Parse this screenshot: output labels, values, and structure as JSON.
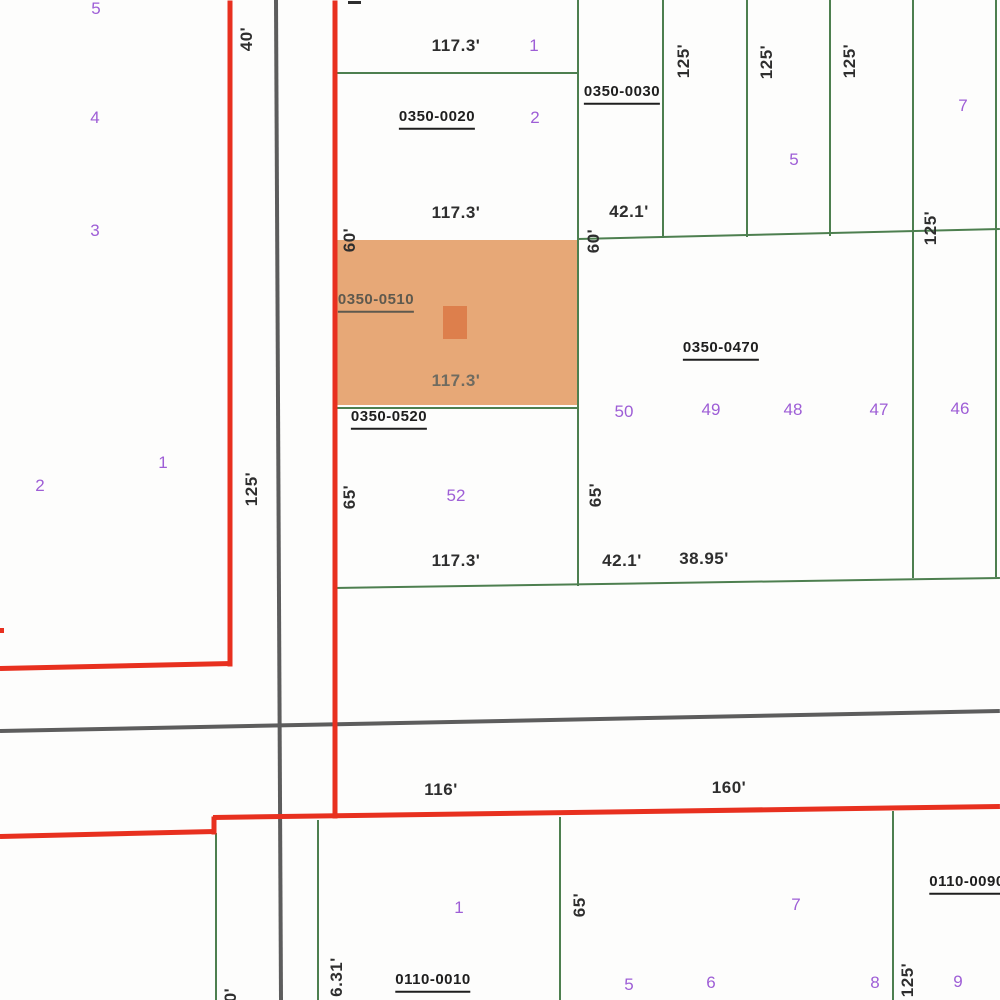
{
  "map": {
    "colors": {
      "background": "#fdfdfc",
      "green": "#4d7f4f",
      "gray": "#5d5d5d",
      "red": "#e8301f",
      "purple": "#9e5ed6",
      "black": "#2e2e2e",
      "muted": "#5e594e",
      "dim_on_orange": "#6f6b60",
      "orange_fill": "#e7a877",
      "orange_marker": "#dd7f4c"
    },
    "highlight_parcel": {
      "id": "0350-0510",
      "x": 333,
      "y": 240,
      "w": 244,
      "h": 165,
      "marker": {
        "x": 443,
        "y": 306,
        "w": 24,
        "h": 33
      }
    },
    "lines": [
      {
        "x1": 578,
        "y1": 0,
        "x2": 578,
        "y2": 586,
        "w": 2,
        "color": "green",
        "name": "parcel-boundary"
      },
      {
        "x1": 663,
        "y1": 0,
        "x2": 663,
        "y2": 238,
        "w": 2,
        "color": "green",
        "name": "parcel-boundary"
      },
      {
        "x1": 747,
        "y1": 0,
        "x2": 747,
        "y2": 237,
        "w": 2,
        "color": "green",
        "name": "parcel-boundary"
      },
      {
        "x1": 830,
        "y1": 0,
        "x2": 830,
        "y2": 236,
        "w": 2,
        "color": "green",
        "name": "parcel-boundary"
      },
      {
        "x1": 913,
        "y1": 0,
        "x2": 913,
        "y2": 578,
        "w": 2,
        "color": "green",
        "name": "parcel-boundary"
      },
      {
        "x1": 996,
        "y1": 0,
        "x2": 996,
        "y2": 577,
        "w": 2,
        "color": "green",
        "name": "parcel-boundary"
      },
      {
        "x1": 335,
        "y1": 73,
        "x2": 577,
        "y2": 73,
        "w": 2,
        "color": "green",
        "name": "parcel-boundary"
      },
      {
        "x1": 578,
        "y1": 239,
        "x2": 1000,
        "y2": 229,
        "w": 2,
        "color": "green",
        "name": "parcel-boundary"
      },
      {
        "x1": 333,
        "y1": 408,
        "x2": 578,
        "y2": 408,
        "w": 2,
        "color": "green",
        "name": "parcel-boundary"
      },
      {
        "x1": 334,
        "y1": 588,
        "x2": 1000,
        "y2": 578,
        "w": 2,
        "color": "green",
        "name": "parcel-boundary"
      },
      {
        "x1": 216,
        "y1": 833,
        "x2": 216,
        "y2": 1000,
        "w": 2,
        "color": "green",
        "name": "parcel-boundary"
      },
      {
        "x1": 318,
        "y1": 820,
        "x2": 318,
        "y2": 1000,
        "w": 2,
        "color": "green",
        "name": "parcel-boundary"
      },
      {
        "x1": 560,
        "y1": 817,
        "x2": 560,
        "y2": 1000,
        "w": 2,
        "color": "green",
        "name": "parcel-boundary"
      },
      {
        "x1": 893,
        "y1": 811,
        "x2": 893,
        "y2": 1000,
        "w": 2,
        "color": "green",
        "name": "parcel-boundary"
      },
      {
        "x1": 276,
        "y1": 0,
        "x2": 281,
        "y2": 1000,
        "w": 4,
        "color": "gray",
        "name": "road-centerline"
      },
      {
        "x1": 0,
        "y1": 731,
        "x2": 1000,
        "y2": 711,
        "w": 4,
        "color": "gray",
        "name": "road-centerline"
      },
      {
        "x1": 230,
        "y1": 0,
        "x2": 230,
        "y2": 666,
        "w": 5,
        "color": "red",
        "name": "zone-boundary"
      },
      {
        "x1": 0,
        "y1": 668,
        "x2": 232,
        "y2": 663,
        "w": 5,
        "color": "red",
        "name": "zone-boundary"
      },
      {
        "x1": 335,
        "y1": 0,
        "x2": 335,
        "y2": 818,
        "w": 5,
        "color": "red",
        "name": "zone-boundary"
      },
      {
        "x1": 214,
        "y1": 816,
        "x2": 214,
        "y2": 834,
        "w": 5,
        "color": "red",
        "name": "zone-boundary"
      },
      {
        "x1": 0,
        "y1": 836,
        "x2": 215,
        "y2": 831,
        "w": 5,
        "color": "red",
        "name": "zone-boundary"
      },
      {
        "x1": 213,
        "y1": 817,
        "x2": 1000,
        "y2": 806,
        "w": 5,
        "color": "red",
        "name": "zone-boundary"
      },
      {
        "x1": 0,
        "y1": 630,
        "x2": 4,
        "y2": 630,
        "w": 5,
        "color": "red",
        "name": "zone-boundary-fragment"
      },
      {
        "x1": 348,
        "y1": 2,
        "x2": 361,
        "y2": 2,
        "w": 3,
        "color": "black",
        "name": "clipped-label-mark"
      }
    ],
    "labels": [
      {
        "t": "0350-0020",
        "x": 437,
        "y": 119,
        "type": "parcel-id"
      },
      {
        "t": "0350-0030",
        "x": 622,
        "y": 94,
        "type": "parcel-id"
      },
      {
        "t": "0350-0470",
        "x": 721,
        "y": 350,
        "type": "parcel-id"
      },
      {
        "t": "0350-0510",
        "x": 376,
        "y": 302,
        "type": "parcel-id",
        "color": "muted"
      },
      {
        "t": "0350-0520",
        "x": 389,
        "y": 419,
        "type": "parcel-id"
      },
      {
        "t": "0110-0010",
        "x": 433,
        "y": 982,
        "type": "parcel-id"
      },
      {
        "t": "0110-0090",
        "x": 967,
        "y": 884,
        "type": "parcel-id"
      },
      {
        "t": "117.3'",
        "x": 456,
        "y": 46,
        "type": "dim"
      },
      {
        "t": "117.3'",
        "x": 456,
        "y": 213,
        "type": "dim"
      },
      {
        "t": "42.1'",
        "x": 629,
        "y": 212,
        "type": "dim"
      },
      {
        "t": "117.3'",
        "x": 456,
        "y": 381,
        "type": "dim",
        "color": "dim_on_orange"
      },
      {
        "t": "117.3'",
        "x": 456,
        "y": 561,
        "type": "dim"
      },
      {
        "t": "42.1'",
        "x": 622,
        "y": 561,
        "type": "dim"
      },
      {
        "t": "38.95'",
        "x": 704,
        "y": 559,
        "type": "dim"
      },
      {
        "t": "116'",
        "x": 441,
        "y": 790,
        "type": "dim"
      },
      {
        "t": "160'",
        "x": 729,
        "y": 788,
        "type": "dim"
      },
      {
        "t": "40'",
        "x": 247,
        "y": 39,
        "type": "dim",
        "rot": true
      },
      {
        "t": "60'",
        "x": 350,
        "y": 240,
        "type": "dim",
        "rot": true
      },
      {
        "t": "60'",
        "x": 594,
        "y": 241,
        "type": "dim",
        "rot": true
      },
      {
        "t": "125'",
        "x": 684,
        "y": 61,
        "type": "dim",
        "rot": true
      },
      {
        "t": "125'",
        "x": 767,
        "y": 62,
        "type": "dim",
        "rot": true
      },
      {
        "t": "125'",
        "x": 850,
        "y": 61,
        "type": "dim",
        "rot": true
      },
      {
        "t": "125'",
        "x": 931,
        "y": 228,
        "type": "dim",
        "rot": true
      },
      {
        "t": "125'",
        "x": 252,
        "y": 489,
        "type": "dim",
        "rot": true
      },
      {
        "t": "65'",
        "x": 350,
        "y": 497,
        "type": "dim",
        "rot": true
      },
      {
        "t": "65'",
        "x": 596,
        "y": 495,
        "type": "dim",
        "rot": true
      },
      {
        "t": "65'",
        "x": 580,
        "y": 905,
        "type": "dim",
        "rot": true
      },
      {
        "t": "125'",
        "x": 908,
        "y": 980,
        "type": "dim",
        "rot": true
      },
      {
        "t": "20'",
        "x": 231,
        "y": 1000,
        "type": "dim",
        "rot": true
      },
      {
        "t": "6.31'",
        "x": 337,
        "y": 977,
        "type": "dim",
        "rot": true
      },
      {
        "t": "5",
        "x": 96,
        "y": 9,
        "type": "lot"
      },
      {
        "t": "4",
        "x": 95,
        "y": 118,
        "type": "lot"
      },
      {
        "t": "3",
        "x": 95,
        "y": 231,
        "type": "lot"
      },
      {
        "t": "2",
        "x": 40,
        "y": 486,
        "type": "lot"
      },
      {
        "t": "1",
        "x": 163,
        "y": 463,
        "type": "lot"
      },
      {
        "t": "1",
        "x": 534,
        "y": 46,
        "type": "lot"
      },
      {
        "t": "2",
        "x": 535,
        "y": 118,
        "type": "lot"
      },
      {
        "t": "5",
        "x": 794,
        "y": 160,
        "type": "lot"
      },
      {
        "t": "7",
        "x": 963,
        "y": 106,
        "type": "lot"
      },
      {
        "t": "50",
        "x": 624,
        "y": 412,
        "type": "lot"
      },
      {
        "t": "49",
        "x": 711,
        "y": 410,
        "type": "lot"
      },
      {
        "t": "48",
        "x": 793,
        "y": 410,
        "type": "lot"
      },
      {
        "t": "47",
        "x": 879,
        "y": 410,
        "type": "lot"
      },
      {
        "t": "46",
        "x": 960,
        "y": 409,
        "type": "lot"
      },
      {
        "t": "52",
        "x": 456,
        "y": 496,
        "type": "lot"
      },
      {
        "t": "1",
        "x": 459,
        "y": 908,
        "type": "lot"
      },
      {
        "t": "7",
        "x": 796,
        "y": 905,
        "type": "lot"
      },
      {
        "t": "5",
        "x": 629,
        "y": 985,
        "type": "lot"
      },
      {
        "t": "6",
        "x": 711,
        "y": 983,
        "type": "lot"
      },
      {
        "t": "8",
        "x": 875,
        "y": 983,
        "type": "lot"
      },
      {
        "t": "9",
        "x": 958,
        "y": 982,
        "type": "lot"
      }
    ]
  }
}
